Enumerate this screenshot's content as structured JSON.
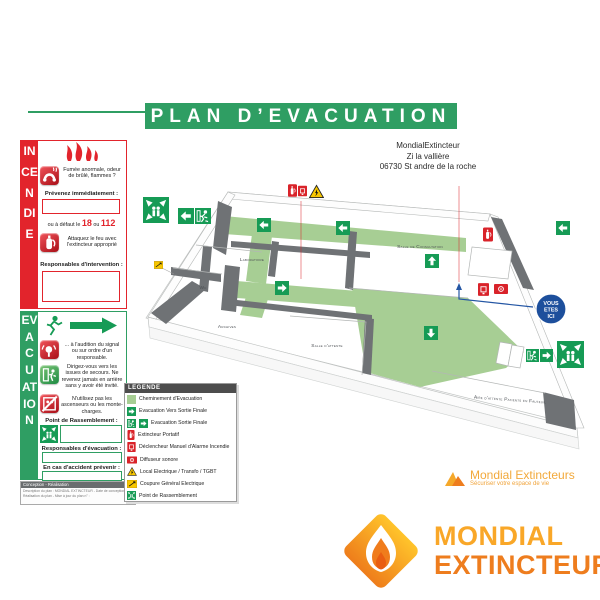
{
  "banner": {
    "title": "PLAN D’EVACUATION",
    "color": "#2F9E63"
  },
  "address": {
    "lines": [
      "MondialExtincteur",
      "Zi la vallière",
      "06730 St andre de la roche"
    ]
  },
  "incendie": {
    "vertical_label": "INCENDIE",
    "color": "#E2242C",
    "step1": "Fumée anormale, odeur de brûlé, flammes ?",
    "notify_label": "Prévenez immédiatement :",
    "fallback": {
      "prefix": "ou à défaut le",
      "num1": "18",
      "or": "ou",
      "num2": "112"
    },
    "step2": "Attaquez le feu avec l'extincteur approprié",
    "responsables_label": "Responsables d'intervention :"
  },
  "evacuation": {
    "vertical_label": "EVACUATION",
    "color": "#2F9E63",
    "step1": "... à l'audition du signal ou sur ordre d'un responsable.",
    "step2": "Dirigez-vous vers les issues de secours. Ne revenez jamais en arrière sans y avoir été invité.",
    "step3": "N'utilisez pas les ascenseurs ou les monte-charges.",
    "rassemblement_label": "Point de Rassemblement :",
    "responsables_label": "Responsables d'évacuation :",
    "accident_label": "En cas d'accident prévenir :"
  },
  "footer": {
    "header": "Conception - Réalisation",
    "line1": "Description du plan : MONDIAL EXTINCTEUR - Date de conception :",
    "line2": "Réalisation du plan - Mise à jour du plan n° :"
  },
  "legend": {
    "title": "LEGENDE",
    "items": [
      {
        "icon": "path-swatch",
        "label": "Cheminement d'Evacuation"
      },
      {
        "icon": "arrow-right",
        "label": "Evacuation Vers Sortie Finale"
      },
      {
        "icon": "exit-final",
        "label": "Evacuation Sortie Finale"
      },
      {
        "icon": "extinguisher",
        "label": "Extincteur Portatif"
      },
      {
        "icon": "manual-call-point",
        "label": "Déclencheur Manuel d'Alarme Incendie"
      },
      {
        "icon": "sounder",
        "label": "Diffuseur sonore"
      },
      {
        "icon": "warning-triangle",
        "label": "Local Electrique / Transfo / TGBT"
      },
      {
        "icon": "power-cut",
        "label": "Coupure Général Electrique"
      },
      {
        "icon": "assembly-point",
        "label": "Point de Rassemblement"
      }
    ]
  },
  "floorplan": {
    "path_color": "#A7CE94",
    "sign_green": "#169B55",
    "alarm_red": "#D9232A",
    "you_are_here_blue": "#1D4F9C",
    "rooms": {
      "laboratoire": "Laboratoire",
      "wc": "Wc",
      "archives": "Archives",
      "salle_attente": "Salle d'attente",
      "consultation": "Salle de Consultation",
      "aire_attente": "Aire d'attente Patients en Fauteuil"
    },
    "you_are_here": [
      "VOUS",
      "ETES",
      "ICI"
    ]
  },
  "logo_small": {
    "name": "Mondial Extincteurs",
    "tagline": "Sécuriser votre espace de vie"
  },
  "logo_large": {
    "line1": "MONDIAL",
    "line2": "EXTINCTEUR"
  }
}
